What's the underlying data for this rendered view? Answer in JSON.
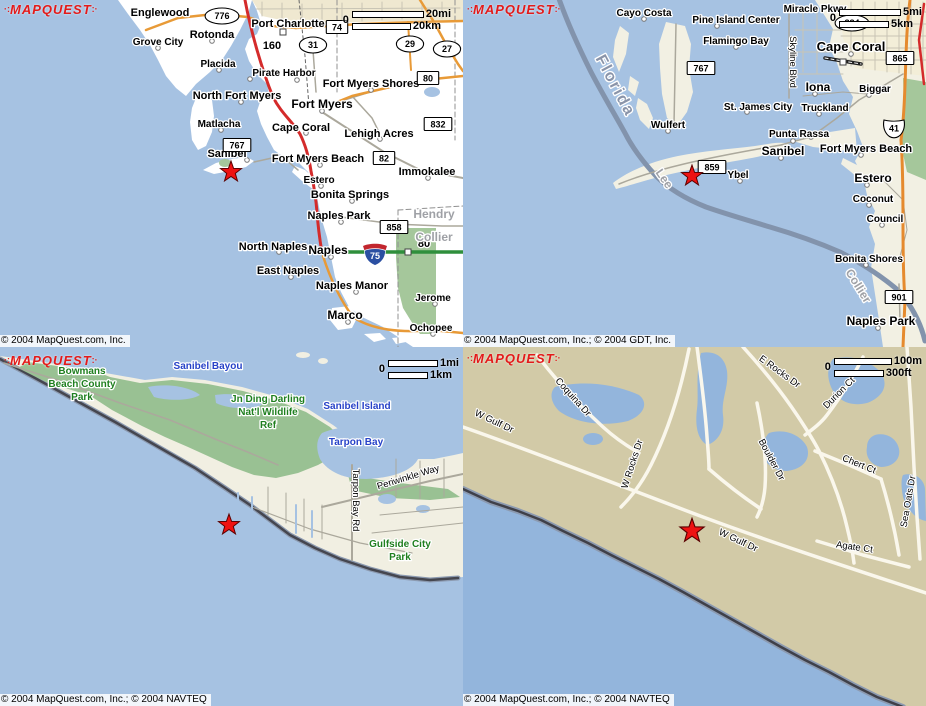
{
  "page": {
    "width": 926,
    "height": 706,
    "app": "MapQuest multi-zoom map views — Sanibel, FL"
  },
  "colors": {
    "water": "#A6C2E2",
    "water_deep": "#93B5DC",
    "land_white": "#FFFFFF",
    "land_ivory": "#F2F0E3",
    "land_tan": "#D2CAA7",
    "park_green": "#99C193",
    "road_orange": "#E89A37",
    "road_red": "#D42B2B",
    "road_green": "#2F8F3C",
    "road_gray": "#ABA89C",
    "star_red": "#EE1212",
    "logo_red": "#E31A1A",
    "label_water_blue": "#2742C8",
    "label_park_green": "#1F7F1F",
    "label_county_gray": "#9FA1A6"
  },
  "tiles": [
    {
      "id": "regional-overview",
      "logo": "MAPQUEST",
      "copyright": "© 2004 MapQuest.com, Inc.",
      "scale": {
        "zero": "0",
        "primary": "20mi",
        "secondary": "20km"
      },
      "star": {
        "x": 231,
        "y": 172
      },
      "labels": [
        {
          "t": "Englewood",
          "x": 160,
          "y": 16
        },
        {
          "t": "Port Charlotte",
          "x": 288,
          "y": 27
        },
        {
          "t": "Grove City",
          "x": 158,
          "y": 45,
          "s": 10
        },
        {
          "t": "Rotonda",
          "x": 212,
          "y": 38
        },
        {
          "t": "Placida",
          "x": 218,
          "y": 67,
          "s": 10
        },
        {
          "t": "Pirate Harbor",
          "x": 284,
          "y": 76,
          "s": 10
        },
        {
          "t": "Fort Myers Shores",
          "x": 371,
          "y": 87
        },
        {
          "t": "North Fort Myers",
          "x": 237,
          "y": 99
        },
        {
          "t": "Fort Myers",
          "x": 322,
          "y": 108,
          "s": 12
        },
        {
          "t": "Matlacha",
          "x": 219,
          "y": 127,
          "s": 10
        },
        {
          "t": "Cape Coral",
          "x": 301,
          "y": 131
        },
        {
          "t": "Lehigh Acres",
          "x": 379,
          "y": 137
        },
        {
          "t": "Sanibel",
          "x": 227,
          "y": 157
        },
        {
          "t": "Fort Myers Beach",
          "x": 318,
          "y": 162
        },
        {
          "t": "Immokalee",
          "x": 427,
          "y": 175
        },
        {
          "t": "Estero",
          "x": 319,
          "y": 183,
          "s": 10
        },
        {
          "t": "Bonita Springs",
          "x": 350,
          "y": 198
        },
        {
          "t": "Naples Park",
          "x": 339,
          "y": 219
        },
        {
          "t": "North Naples",
          "x": 273,
          "y": 250
        },
        {
          "t": "Naples",
          "x": 328,
          "y": 254,
          "s": 12
        },
        {
          "t": "East Naples",
          "x": 288,
          "y": 274
        },
        {
          "t": "Naples Manor",
          "x": 352,
          "y": 289
        },
        {
          "t": "Jerome",
          "x": 433,
          "y": 301,
          "s": 10
        },
        {
          "t": "Marco",
          "x": 345,
          "y": 319,
          "s": 12
        },
        {
          "t": "Ochopee",
          "x": 431,
          "y": 331,
          "s": 10
        },
        {
          "t": "160",
          "x": 272,
          "y": 49
        },
        {
          "t": "80",
          "x": 424,
          "y": 247
        },
        {
          "t": "Hendry",
          "x": 434,
          "y": 218,
          "c": "co"
        },
        {
          "t": "Collier",
          "x": 434,
          "y": 241,
          "c": "co"
        }
      ],
      "shields": [
        {
          "y2": "e",
          "t": "776",
          "x": 222,
          "y": 16
        },
        {
          "y2": "b",
          "t": "74",
          "x": 337,
          "y": 27
        },
        {
          "y2": "e",
          "t": "31",
          "x": 313,
          "y": 45
        },
        {
          "y2": "e",
          "t": "29",
          "x": 410,
          "y": 44
        },
        {
          "y2": "e",
          "t": "27",
          "x": 447,
          "y": 49
        },
        {
          "y2": "b",
          "t": "80",
          "x": 428,
          "y": 78
        },
        {
          "y2": "b",
          "t": "832",
          "x": 438,
          "y": 124
        },
        {
          "y2": "b",
          "t": "767",
          "x": 237,
          "y": 145
        },
        {
          "y2": "b",
          "t": "82",
          "x": 384,
          "y": 158
        },
        {
          "y2": "b",
          "t": "858",
          "x": 394,
          "y": 227
        },
        {
          "y2": "i",
          "t": "75",
          "x": 375,
          "y": 255
        }
      ]
    },
    {
      "id": "area-view",
      "logo": "MAPQUEST",
      "copyright": "© 2004 MapQuest.com, Inc.; © 2004 GDT, Inc.",
      "scale": {
        "zero": "0",
        "primary": "5mi",
        "secondary": "5km"
      },
      "star": {
        "x": 229,
        "y": 176
      },
      "labels": [
        {
          "t": "Cayo Costa",
          "x": 181,
          "y": 16,
          "s": 10
        },
        {
          "t": "Pine Island Center",
          "x": 273,
          "y": 23,
          "s": 10
        },
        {
          "t": "Miracle Pkwy",
          "x": 352,
          "y": 12,
          "s": 10
        },
        {
          "t": "Flamingo Bay",
          "x": 273,
          "y": 44,
          "s": 10
        },
        {
          "t": "Cape Coral",
          "x": 388,
          "y": 51,
          "s": 13
        },
        {
          "t": "Iona",
          "x": 355,
          "y": 91,
          "s": 12
        },
        {
          "t": "Biggar",
          "x": 412,
          "y": 92,
          "s": 10
        },
        {
          "t": "St. James City",
          "x": 295,
          "y": 110,
          "s": 10
        },
        {
          "t": "Truckland",
          "x": 362,
          "y": 111,
          "s": 10
        },
        {
          "t": "Wulfert",
          "x": 205,
          "y": 128,
          "s": 10
        },
        {
          "t": "Punta Rassa",
          "x": 336,
          "y": 137,
          "s": 10
        },
        {
          "t": "Sanibel",
          "x": 320,
          "y": 155,
          "s": 12
        },
        {
          "t": "Fort Myers Beach",
          "x": 403,
          "y": 152
        },
        {
          "t": "Ybel",
          "x": 275,
          "y": 178,
          "s": 10
        },
        {
          "t": "Estero",
          "x": 410,
          "y": 182,
          "s": 12
        },
        {
          "t": "Coconut",
          "x": 410,
          "y": 202,
          "s": 10
        },
        {
          "t": "Council",
          "x": 422,
          "y": 222,
          "s": 10
        },
        {
          "t": "Bonita Shores",
          "x": 406,
          "y": 262,
          "s": 10
        },
        {
          "t": "Naples Park",
          "x": 418,
          "y": 325,
          "s": 12
        },
        {
          "t": "Florida",
          "x": 148,
          "y": 88,
          "r": 62,
          "c": "fl"
        },
        {
          "t": "Lee",
          "x": 198,
          "y": 181,
          "r": 55,
          "c": "co"
        },
        {
          "t": "Collier",
          "x": 392,
          "y": 288,
          "r": 58,
          "c": "co"
        },
        {
          "t": "Skyline Blvd",
          "x": 327,
          "y": 62,
          "r": 90,
          "c": "st"
        }
      ],
      "shields": [
        {
          "y2": "e",
          "t": "884",
          "x": 389,
          "y": 23
        },
        {
          "y2": "b",
          "t": "865",
          "x": 437,
          "y": 58
        },
        {
          "y2": "b",
          "t": "767",
          "x": 238,
          "y": 68
        },
        {
          "y2": "u",
          "t": "41",
          "x": 431,
          "y": 128
        },
        {
          "y2": "b",
          "t": "859",
          "x": 249,
          "y": 167
        },
        {
          "y2": "b",
          "t": "901",
          "x": 436,
          "y": 297
        }
      ]
    },
    {
      "id": "island-view",
      "logo": "MAPQUEST",
      "copyright": "© 2004 MapQuest.com, Inc.; © 2004 NAVTEQ",
      "scale": {
        "zero": "0",
        "primary": "1mi",
        "secondary": "1km"
      },
      "star": {
        "x": 229,
        "y": 178
      },
      "labels": [
        {
          "t": "Bowmans",
          "x": 82,
          "y": 27,
          "c": "pk"
        },
        {
          "t": "Beach County",
          "x": 82,
          "y": 40,
          "c": "pk"
        },
        {
          "t": "Park",
          "x": 82,
          "y": 53,
          "c": "pk"
        },
        {
          "t": "Jn Ding Darling",
          "x": 268,
          "y": 55,
          "c": "pk"
        },
        {
          "t": "Nat'l Wildlife",
          "x": 268,
          "y": 68,
          "c": "pk"
        },
        {
          "t": "Ref",
          "x": 268,
          "y": 81,
          "c": "pk"
        },
        {
          "t": "Gulfside City",
          "x": 400,
          "y": 200,
          "c": "pk"
        },
        {
          "t": "Park",
          "x": 400,
          "y": 213,
          "c": "pk"
        },
        {
          "t": "Sanibel Bayou",
          "x": 208,
          "y": 22,
          "c": "wa"
        },
        {
          "t": "Sanibel Island",
          "x": 357,
          "y": 62,
          "c": "wa"
        },
        {
          "t": "Tarpon Bay",
          "x": 356,
          "y": 98,
          "c": "wa"
        },
        {
          "t": "Tarpon Bay Rd",
          "x": 353,
          "y": 153,
          "r": 90,
          "c": "st"
        },
        {
          "t": "Periwinkle Way",
          "x": 409,
          "y": 133,
          "r": -17,
          "c": "st"
        }
      ],
      "shields": []
    },
    {
      "id": "street-view",
      "logo": "MAPQUEST",
      "copyright": "© 2004 MapQuest.com, Inc.; © 2004 NAVTEQ",
      "scale": {
        "zero": "0",
        "primary": "100m",
        "secondary": "300ft"
      },
      "star": {
        "x": 229,
        "y": 184
      },
      "labels": [
        {
          "t": "W Gulf Dr",
          "x": 30,
          "y": 77,
          "r": 25,
          "c": "st"
        },
        {
          "t": "Coquina Dr",
          "x": 108,
          "y": 52,
          "r": 48,
          "c": "st"
        },
        {
          "t": "W Rocks Dr",
          "x": 172,
          "y": 118,
          "r": -72,
          "c": "st"
        },
        {
          "t": "E Rocks Dr",
          "x": 315,
          "y": 27,
          "r": 36,
          "c": "st"
        },
        {
          "t": "Durion Ct",
          "x": 378,
          "y": 48,
          "r": -45,
          "c": "st"
        },
        {
          "t": "Boulder Dr",
          "x": 306,
          "y": 114,
          "r": 62,
          "c": "st"
        },
        {
          "t": "Chert Ct",
          "x": 395,
          "y": 120,
          "r": 22,
          "c": "st"
        },
        {
          "t": "Sea Oats Dr",
          "x": 448,
          "y": 155,
          "r": -80,
          "c": "st"
        },
        {
          "t": "W Gulf Dr",
          "x": 274,
          "y": 196,
          "r": 25,
          "c": "st"
        },
        {
          "t": "Agate Ct",
          "x": 391,
          "y": 203,
          "r": 8,
          "c": "st"
        }
      ],
      "shields": []
    }
  ]
}
